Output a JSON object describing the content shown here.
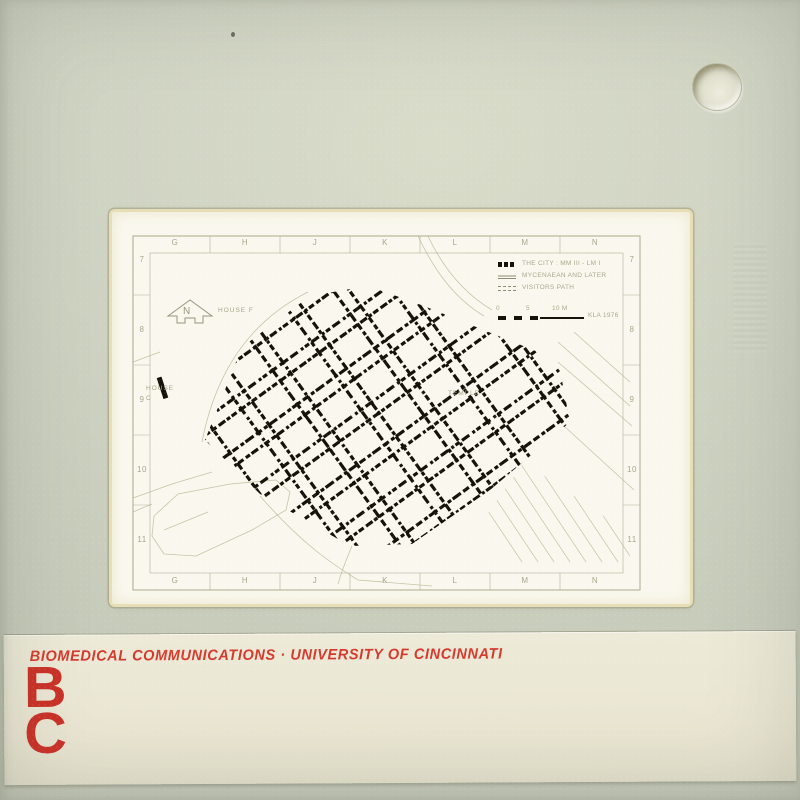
{
  "colors": {
    "mount": "#cfd3c2",
    "film": "#faf8ee",
    "ink": "#15120a",
    "label_bg": "#eae6d3",
    "label_red": "#d63a2e"
  },
  "caption": {
    "text": "BIOMEDICAL COMMUNICATIONS · UNIVERSITY OF CINCINNATI",
    "logo_top": "B",
    "logo_bottom": "C"
  },
  "map": {
    "grid_letters": [
      "G",
      "H",
      "J",
      "K",
      "L",
      "M",
      "N"
    ],
    "grid_numbers": [
      "7",
      "8",
      "9",
      "10",
      "11"
    ],
    "north_label": "N",
    "labels": {
      "house_f": "HOUSE F",
      "house_c": "HOUSE C",
      "temple": "TEMPLE"
    },
    "legend": {
      "items": [
        {
          "swatch": "solid",
          "text": "THE CITY : MM III - LM I"
        },
        {
          "swatch": "hatched",
          "text": "MYCENAEAN AND LATER"
        },
        {
          "swatch": "dashed",
          "text": "VISITORS PATH"
        }
      ],
      "scale_ticks": [
        "0",
        "5",
        "10 M"
      ],
      "credit": "KLA 1976"
    }
  }
}
